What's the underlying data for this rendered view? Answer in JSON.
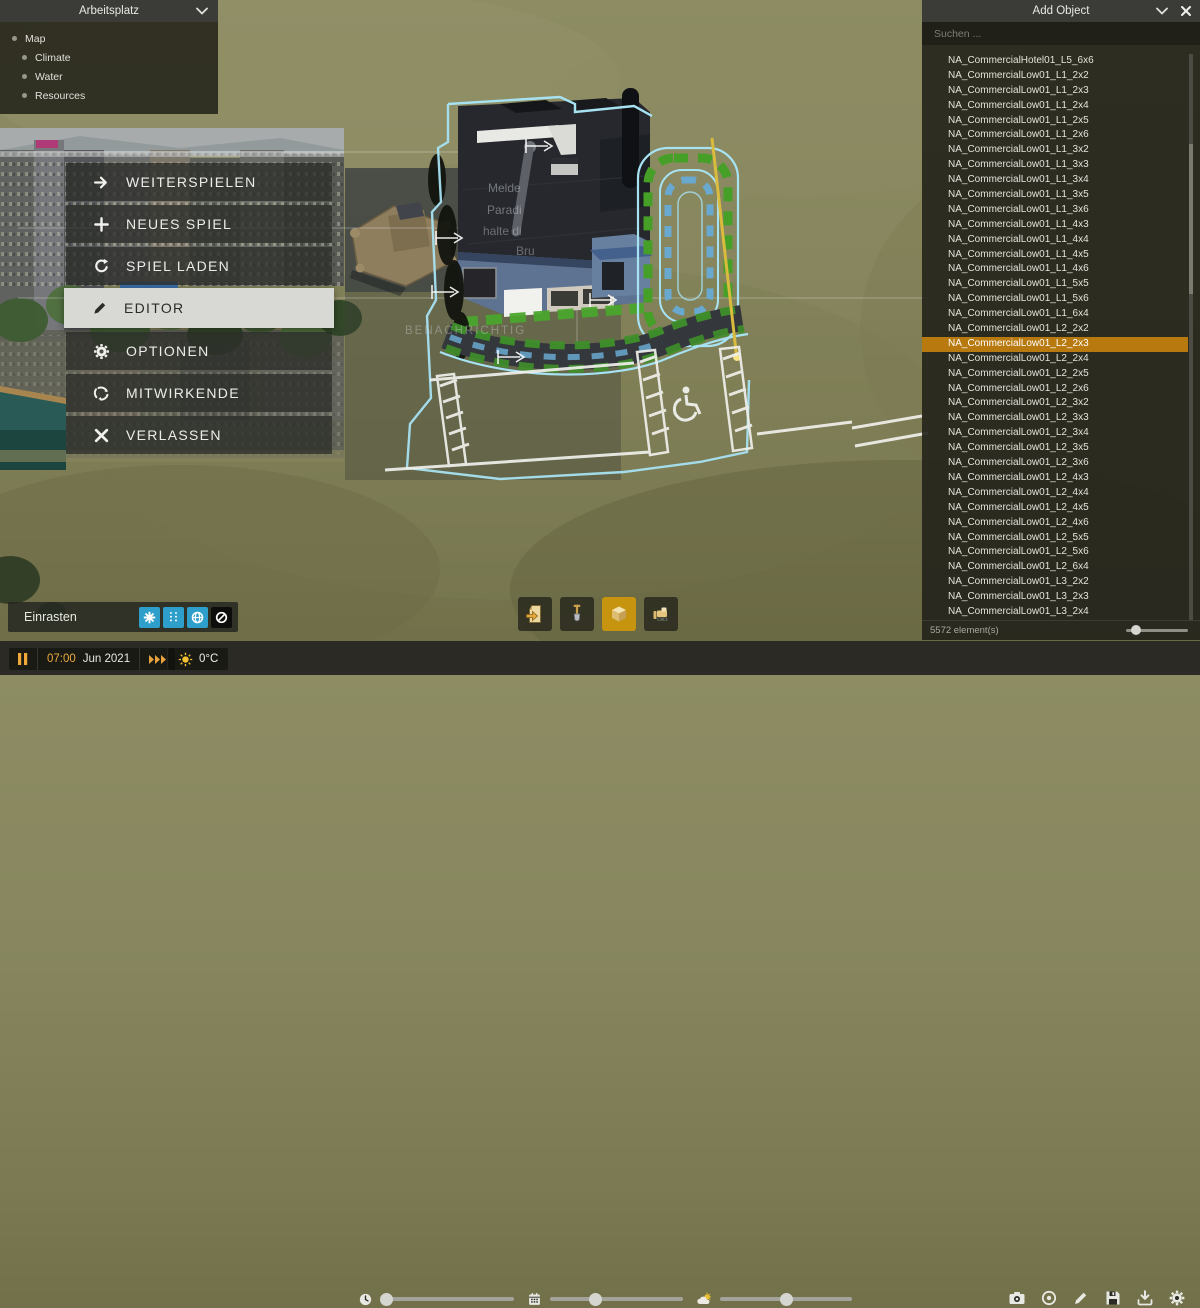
{
  "workspace_panel": {
    "title": "Arbeitsplatz",
    "items": [
      {
        "label": "Map",
        "indent": 0
      },
      {
        "label": "Climate",
        "indent": 1
      },
      {
        "label": "Water",
        "indent": 1
      },
      {
        "label": "Resources",
        "indent": 1
      }
    ]
  },
  "main_menu": {
    "items": [
      {
        "label": "WEITERSPIELEN",
        "icon": "arrow-right",
        "active": false
      },
      {
        "label": "NEUES SPIEL",
        "icon": "plus",
        "active": false
      },
      {
        "label": "SPIEL LADEN",
        "icon": "reload",
        "active": false
      },
      {
        "label": "EDITOR",
        "icon": "pencil",
        "active": true
      },
      {
        "label": "OPTIONEN",
        "icon": "gear",
        "active": false
      },
      {
        "label": "MITWIRKENDE",
        "icon": "paradox",
        "active": false
      },
      {
        "label": "VERLASSEN",
        "icon": "close",
        "active": false
      }
    ]
  },
  "add_object_panel": {
    "title": "Add Object",
    "search_placeholder": "Suchen ...",
    "footer": "5572 element(s)",
    "selected_index": 19,
    "items": [
      "NA_CommercialHotel01_L5_6x6",
      "NA_CommercialLow01_L1_2x2",
      "NA_CommercialLow01_L1_2x3",
      "NA_CommercialLow01_L1_2x4",
      "NA_CommercialLow01_L1_2x5",
      "NA_CommercialLow01_L1_2x6",
      "NA_CommercialLow01_L1_3x2",
      "NA_CommercialLow01_L1_3x3",
      "NA_CommercialLow01_L1_3x4",
      "NA_CommercialLow01_L1_3x5",
      "NA_CommercialLow01_L1_3x6",
      "NA_CommercialLow01_L1_4x3",
      "NA_CommercialLow01_L1_4x4",
      "NA_CommercialLow01_L1_4x5",
      "NA_CommercialLow01_L1_4x6",
      "NA_CommercialLow01_L1_5x5",
      "NA_CommercialLow01_L1_5x6",
      "NA_CommercialLow01_L1_6x4",
      "NA_CommercialLow01_L2_2x2",
      "NA_CommercialLow01_L2_2x3",
      "NA_CommercialLow01_L2_2x4",
      "NA_CommercialLow01_L2_2x5",
      "NA_CommercialLow01_L2_2x6",
      "NA_CommercialLow01_L2_3x2",
      "NA_CommercialLow01_L2_3x3",
      "NA_CommercialLow01_L2_3x4",
      "NA_CommercialLow01_L2_3x5",
      "NA_CommercialLow01_L2_3x6",
      "NA_CommercialLow01_L2_4x3",
      "NA_CommercialLow01_L2_4x4",
      "NA_CommercialLow01_L2_4x5",
      "NA_CommercialLow01_L2_4x6",
      "NA_CommercialLow01_L2_5x5",
      "NA_CommercialLow01_L2_5x6",
      "NA_CommercialLow01_L2_6x4",
      "NA_CommercialLow01_L3_2x2",
      "NA_CommercialLow01_L3_2x3",
      "NA_CommercialLow01_L3_2x4"
    ]
  },
  "snap_toolbar": {
    "label": "Einrasten",
    "buttons": [
      {
        "icon": "star-snap-icon",
        "active": true
      },
      {
        "icon": "guideline-snap-icon",
        "active": true
      },
      {
        "icon": "globe-snap-icon",
        "active": true
      },
      {
        "icon": "snap-disabled-icon",
        "active": false
      }
    ]
  },
  "editor_toolbar": {
    "buttons": [
      {
        "icon": "import-document-icon",
        "active": false
      },
      {
        "icon": "shovel-icon",
        "active": false
      },
      {
        "icon": "cube-icon",
        "active": true
      },
      {
        "icon": "bulldozer-icon",
        "active": false
      }
    ]
  },
  "time_controls": {
    "time": "07:00",
    "date": "Jun 2021",
    "temperature": "0°C"
  },
  "environment_sliders": [
    {
      "icon": "clock",
      "value_pct": 4
    },
    {
      "icon": "calendar",
      "value_pct": 34
    },
    {
      "icon": "weather",
      "value_pct": 50
    }
  ],
  "bottom_right_toolbar": [
    "camera",
    "record",
    "pencil",
    "save",
    "download",
    "gear"
  ],
  "scene_text": {
    "notification_fragment": "BENACHRICHTIG",
    "lines": [
      "Melde",
      "Paradi",
      "halte di",
      "Bru"
    ]
  },
  "colors": {
    "accent_orange": "#b8790f",
    "snap_blue": "#2d9fca",
    "tool_gold": "#c79410",
    "time_orange": "#eba93f",
    "selection_cyan": "#a6e2f2",
    "zone_green": "#46a028",
    "guide_yellow": "#d9bb3e"
  }
}
